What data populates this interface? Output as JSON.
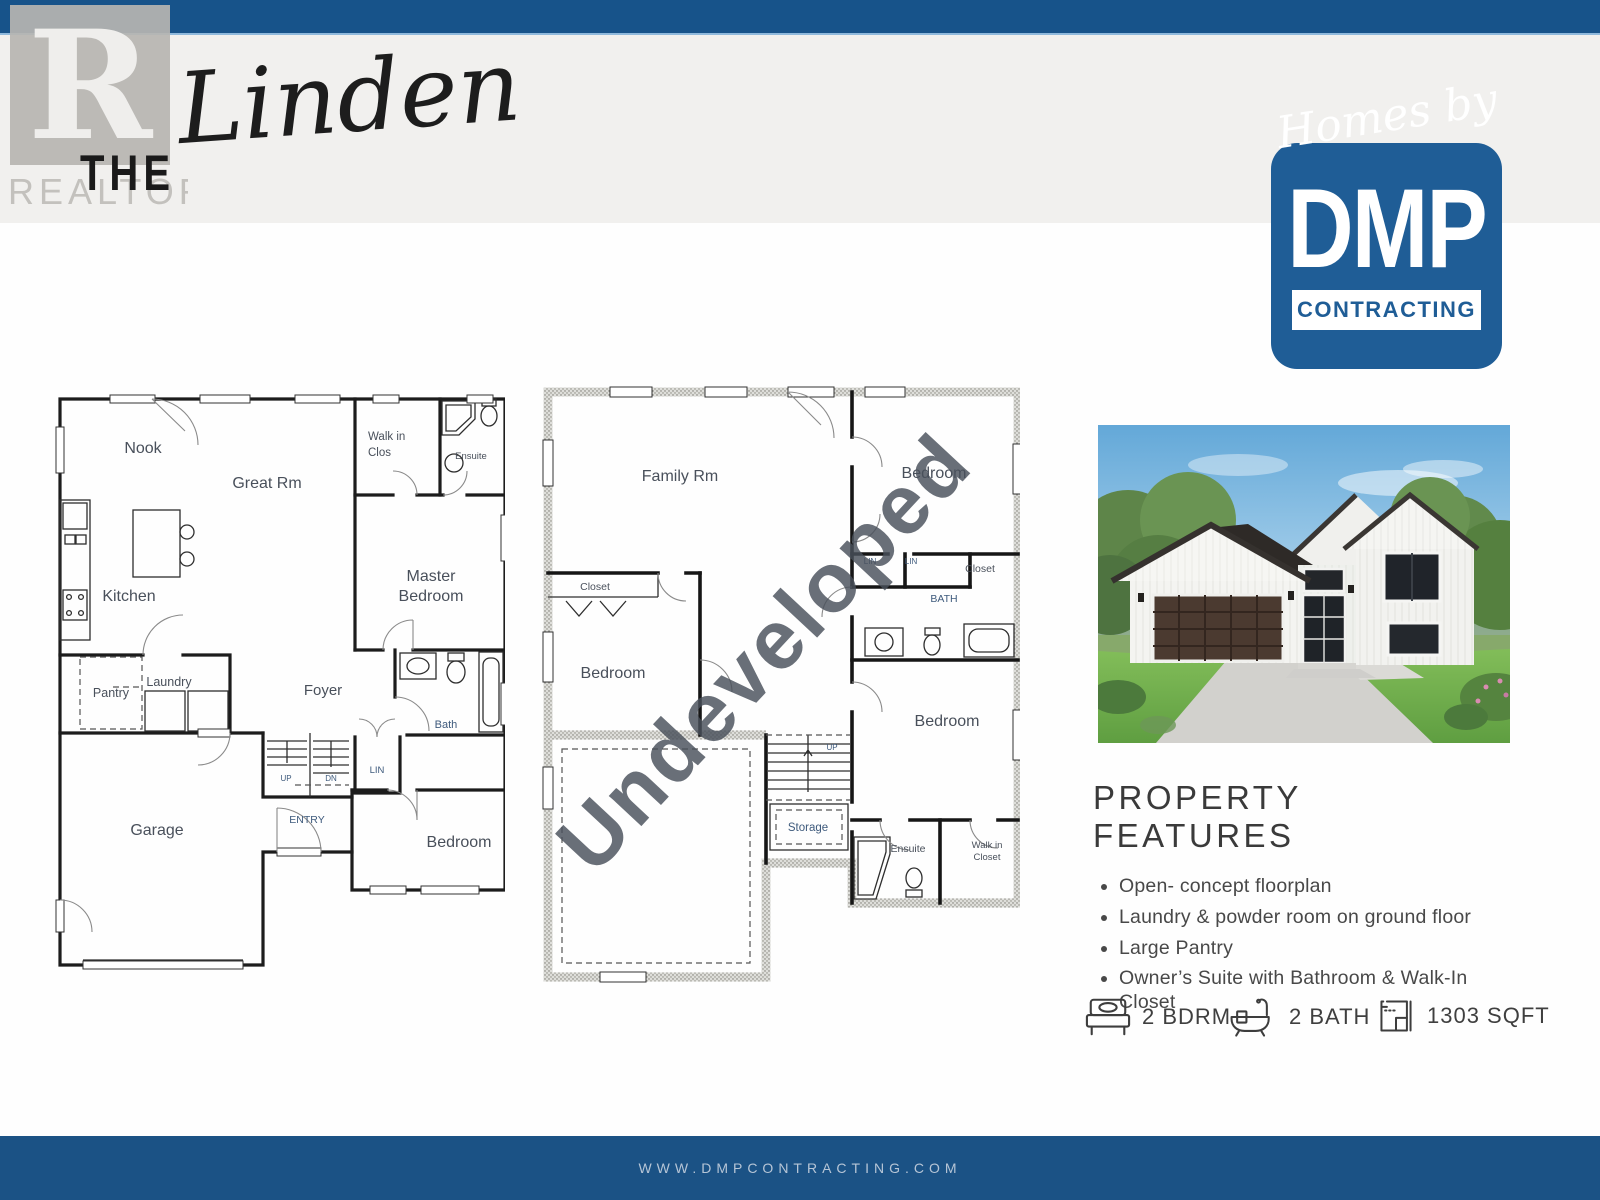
{
  "header": {
    "the": "THE",
    "model": "Linden",
    "realtor_r": "R",
    "realtor_label": "REALTOR®"
  },
  "logo": {
    "script": "Homes by",
    "name": "DMP",
    "banner": "CONTRACTING"
  },
  "floorplans": {
    "main": {
      "labels": [
        "Nook",
        "Great Rm",
        "Walk in",
        "Clos",
        "Ensuite",
        "Kitchen",
        "Master",
        "Bedroom",
        "Pantry",
        "Laundry",
        "Foyer",
        "Bath",
        "LIN",
        "UP",
        "DN",
        "ENTRY",
        "Garage",
        "Bedroom"
      ]
    },
    "basement": {
      "watermark": "Undeveloped",
      "labels": [
        "Family Rm",
        "Bedroom",
        "Closet",
        "LIN",
        "LIN",
        "Closet",
        "BATH",
        "Bedroom",
        "UP",
        "Storage",
        "Bedroom",
        "Ensuite",
        "Walk in",
        "Closet"
      ]
    }
  },
  "features": {
    "title": "PROPERTY FEATURES",
    "items": [
      "Open- concept floorplan",
      "Laundry & powder room on ground floor",
      "Large Pantry",
      "Owner’s Suite with Bathroom & Walk-In Closet"
    ]
  },
  "stats": [
    {
      "icon": "bed-icon",
      "label": "2 BDRM"
    },
    {
      "icon": "bath-icon",
      "label": "2 BATH"
    },
    {
      "icon": "floorplan-icon",
      "label": "1303 SQFT"
    }
  ],
  "footer": {
    "website": "WWW.DMPCONTRACTING.COM"
  },
  "colors": {
    "brand_blue": "#17538a",
    "logo_blue": "#1f5d96",
    "band_gray": "#f1f0ee",
    "watermark_gray": "#8b8b82",
    "footer_text": "#b6c5d6"
  }
}
